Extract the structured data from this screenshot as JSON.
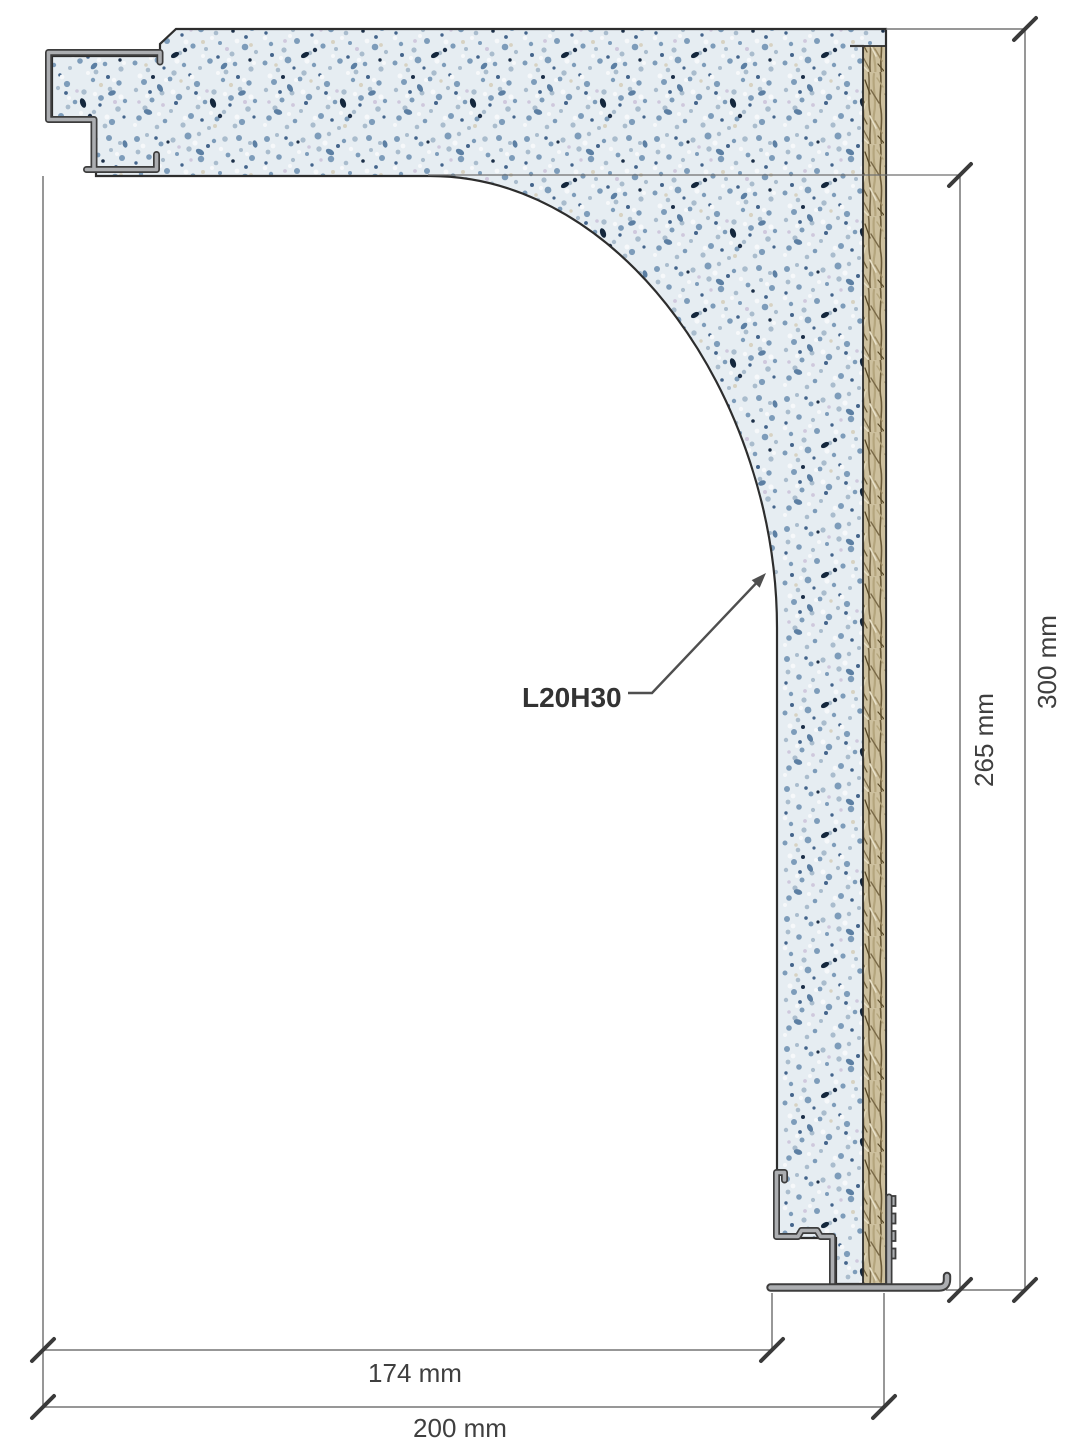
{
  "drawing": {
    "label": "L20H30",
    "dim_174": "174 mm",
    "dim_200": "200 mm",
    "dim_265": "265 mm",
    "dim_300": "300 mm",
    "colors": {
      "background": "#ffffff",
      "terrazzo_base": "#e6edf2",
      "terrazzo_speckle_blue": "#7d9cba",
      "terrazzo_speckle_dark": "#1d3049",
      "wood_base": "#cdc09e",
      "wood_strand": "#7a6a48",
      "metal_fill": "#acaeb1",
      "outline": "#2d2d2d",
      "dimension_line": "#757575",
      "text": "#3f3f3f"
    }
  }
}
